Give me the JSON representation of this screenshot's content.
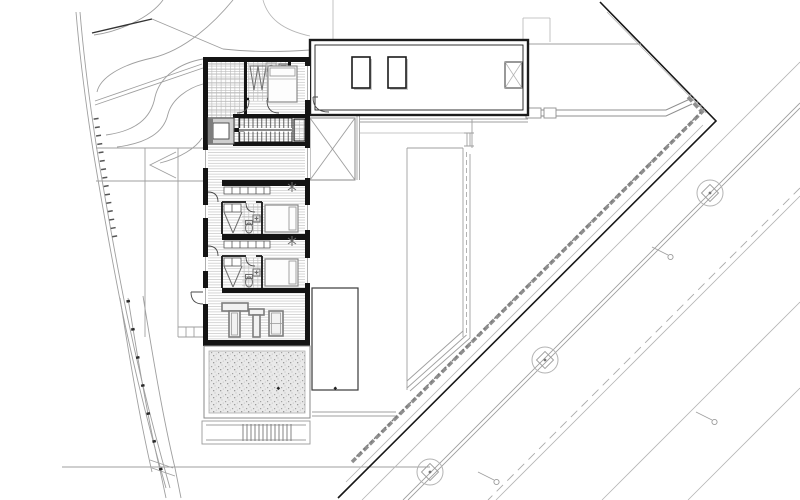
{
  "sheet": {
    "background": "#ffffff",
    "description": "Black and white architectural site / floor plan: elongated north-south residence with entry terrace, WC, north bedroom, switchback stair with shaft and fireplace, open living area, two bedroom suites with bathrooms and closet rows, utility-gym room, gravel terrace with garden steps, attached garage wing with two skylights and a crossed shaft, lawn court with terraced corner, hedge and black boundary at the street corner, tree-lined diagonal roads to the east and terrain contours with a curved boundary to the west."
  },
  "palette": {
    "wall_black": "#141414",
    "thin_gray": "#9f9f9f",
    "medium_gray": "#7d7d7d",
    "hedge_gray": "#8a8a8a",
    "boundary_black": "#171717",
    "hatch_gray": "#c9c9c9",
    "tile_gray": "#b9b9b9",
    "gravel_bg": "#e9e9e9",
    "gravel_dot": "#a3a3a3"
  },
  "building": {
    "rooms": [
      {
        "name": "entry-terrace",
        "floor": "tile-grid"
      },
      {
        "name": "wc-dressing",
        "fixtures": [
          "wardrobe-triangles",
          "washbasin",
          "wc"
        ]
      },
      {
        "name": "bedroom-north",
        "fixtures": [
          "double-bed"
        ]
      },
      {
        "name": "stair-core",
        "fixtures": [
          "switchback-stair",
          "shaft",
          "fireplace"
        ]
      },
      {
        "name": "living-area",
        "floor": "wood-strip-hatch"
      },
      {
        "name": "suite-1",
        "fixtures": [
          "closet-row",
          "shower",
          "wc",
          "washbasin",
          "bed"
        ]
      },
      {
        "name": "suite-2",
        "fixtures": [
          "closet-row",
          "shower",
          "wc",
          "washbasin",
          "bed"
        ]
      },
      {
        "name": "utility-gym",
        "fixtures": [
          "equipment-1",
          "equipment-2",
          "locker"
        ]
      }
    ],
    "window_gaps_west": 4,
    "window_gaps_east": 4
  },
  "garage": {
    "skylights": 2,
    "crossed_shaft": 1,
    "door": "quarter-swing"
  },
  "site": {
    "features": [
      "terrain-contours",
      "west-boundary-curve",
      "entry-ramp",
      "west-walkway",
      "gravel-terrace",
      "garden-steps",
      "spa-deck",
      "lawn-court",
      "x-deck",
      "fences",
      "hedge",
      "corner-boundary",
      "roads",
      "southwest-path"
    ],
    "trees": 3,
    "street_lamps": 3,
    "road_lines": 6
  }
}
